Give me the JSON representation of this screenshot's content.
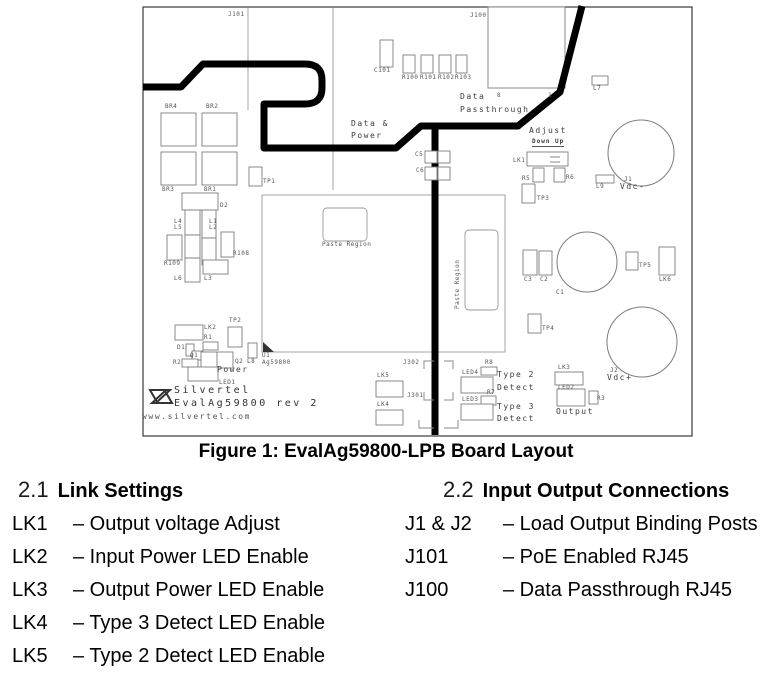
{
  "colors": {
    "background": "#ffffff",
    "text": "#000000",
    "silkscreen": "#555555",
    "trace": "#000000"
  },
  "figure_caption": "Figure 1: EvalAg59800-LPB Board Layout",
  "sections": {
    "link_settings": {
      "number": "2.1",
      "title": "Link Settings",
      "items": [
        {
          "term": "LK1",
          "desc": "– Output voltage Adjust"
        },
        {
          "term": "LK2",
          "desc": "– Input Power LED Enable"
        },
        {
          "term": "LK3",
          "desc": "– Output Power LED Enable"
        },
        {
          "term": "LK4",
          "desc": "– Type 3 Detect LED Enable"
        },
        {
          "term": "LK5",
          "desc": "– Type 2 Detect LED Enable"
        }
      ]
    },
    "io_connections": {
      "number": "2.2",
      "title": "Input Output Connections",
      "items": [
        {
          "term": "J1 & J2",
          "desc": "– Load Output Binding Posts"
        },
        {
          "term": "J101",
          "desc": "– PoE Enabled RJ45"
        },
        {
          "term": "J100",
          "desc": "– Data Passthrough RJ45"
        }
      ]
    }
  },
  "board": {
    "silkscreen_labels": [
      {
        "t": "J101",
        "x": 228,
        "y": 12
      },
      {
        "t": "J100",
        "x": 470,
        "y": 13
      },
      {
        "t": "C101",
        "x": 374,
        "y": 68
      },
      {
        "t": "R100",
        "x": 402,
        "y": 75
      },
      {
        "t": "R101",
        "x": 420,
        "y": 75
      },
      {
        "t": "R102",
        "x": 438,
        "y": 75
      },
      {
        "t": "R103",
        "x": 455,
        "y": 75
      },
      {
        "t": "L7",
        "x": 593,
        "y": 86
      },
      {
        "t": "Data",
        "x": 460,
        "y": 93,
        "c": "m"
      },
      {
        "t": "8",
        "x": 497,
        "y": 93
      },
      {
        "t": "1",
        "x": 548,
        "y": 93
      },
      {
        "t": "Passthrough",
        "x": 460,
        "y": 106,
        "c": "m"
      },
      {
        "t": "BR4",
        "x": 165,
        "y": 104
      },
      {
        "t": "BR2",
        "x": 206,
        "y": 104
      },
      {
        "t": "BR3",
        "x": 162,
        "y": 187
      },
      {
        "t": "BR1",
        "x": 204,
        "y": 187
      },
      {
        "t": "TP1",
        "x": 263,
        "y": 179
      },
      {
        "t": "Data &",
        "x": 351,
        "y": 120,
        "c": "m"
      },
      {
        "t": "Power",
        "x": 351,
        "y": 132,
        "c": "m"
      },
      {
        "t": "C5",
        "x": 415,
        "y": 152
      },
      {
        "t": "C6",
        "x": 416,
        "y": 168
      },
      {
        "t": "D2",
        "x": 220,
        "y": 203
      },
      {
        "t": "L4",
        "x": 174,
        "y": 219
      },
      {
        "t": "L5",
        "x": 174,
        "y": 225
      },
      {
        "t": "L1",
        "x": 209,
        "y": 219
      },
      {
        "t": "L2",
        "x": 209,
        "y": 225
      },
      {
        "t": "R109",
        "x": 164,
        "y": 261
      },
      {
        "t": "R108",
        "x": 233,
        "y": 251
      },
      {
        "t": "L6",
        "x": 174,
        "y": 276
      },
      {
        "t": "L3",
        "x": 204,
        "y": 276
      },
      {
        "t": "Paste Region",
        "x": 322,
        "y": 242
      },
      {
        "t": "Paste Region",
        "x": 455,
        "y": 309,
        "c": "v"
      },
      {
        "t": "Adjust",
        "x": 529,
        "y": 127,
        "c": "m"
      },
      {
        "t": "Down Up",
        "x": 532,
        "y": 139,
        "c": "u"
      },
      {
        "t": "LK1",
        "x": 513,
        "y": 158
      },
      {
        "t": "R5",
        "x": 522,
        "y": 176
      },
      {
        "t": "R6",
        "x": 566,
        "y": 175
      },
      {
        "t": "TP3",
        "x": 537,
        "y": 196
      },
      {
        "t": "L9",
        "x": 596,
        "y": 184
      },
      {
        "t": "J1",
        "x": 624,
        "y": 177
      },
      {
        "t": "Vdc-",
        "x": 620,
        "y": 183,
        "c": "m"
      },
      {
        "t": "C3",
        "x": 524,
        "y": 277
      },
      {
        "t": "C2",
        "x": 540,
        "y": 277
      },
      {
        "t": "C1",
        "x": 556,
        "y": 290
      },
      {
        "t": "TP5",
        "x": 639,
        "y": 263
      },
      {
        "t": "LK6",
        "x": 659,
        "y": 277
      },
      {
        "t": "TP4",
        "x": 542,
        "y": 326
      },
      {
        "t": "J2",
        "x": 610,
        "y": 368
      },
      {
        "t": "Vdc+",
        "x": 607,
        "y": 374,
        "c": "m"
      },
      {
        "t": "LK2",
        "x": 204,
        "y": 325
      },
      {
        "t": "TP2",
        "x": 229,
        "y": 318
      },
      {
        "t": "R1",
        "x": 204,
        "y": 335
      },
      {
        "t": "D1",
        "x": 177,
        "y": 345
      },
      {
        "t": "Q1",
        "x": 190,
        "y": 353
      },
      {
        "t": "R2",
        "x": 173,
        "y": 360
      },
      {
        "t": "Q2",
        "x": 235,
        "y": 359
      },
      {
        "t": "Power",
        "x": 217,
        "y": 366,
        "c": "m"
      },
      {
        "t": "LED1",
        "x": 219,
        "y": 380
      },
      {
        "t": "L8",
        "x": 247,
        "y": 359
      },
      {
        "t": "U1",
        "x": 262,
        "y": 353
      },
      {
        "t": "Ag59800",
        "x": 262,
        "y": 360
      },
      {
        "t": "Silvertel",
        "x": 174,
        "y": 386,
        "c": "l"
      },
      {
        "t": "EvalAg59800 rev 2",
        "x": 174,
        "y": 399,
        "c": "l"
      },
      {
        "t": "www.silvertel.com",
        "x": 142,
        "y": 413,
        "c": "w"
      },
      {
        "t": "J302",
        "x": 403,
        "y": 360
      },
      {
        "t": "LK5",
        "x": 377,
        "y": 373
      },
      {
        "t": "J301",
        "x": 407,
        "y": 393
      },
      {
        "t": "LK4",
        "x": 377,
        "y": 402
      },
      {
        "t": "R8",
        "x": 485,
        "y": 360
      },
      {
        "t": "LED4",
        "x": 462,
        "y": 370
      },
      {
        "t": "R7",
        "x": 487,
        "y": 390
      },
      {
        "t": "LED3",
        "x": 462,
        "y": 397
      },
      {
        "t": "Type 2",
        "x": 497,
        "y": 371,
        "c": "m"
      },
      {
        "t": "Detect",
        "x": 497,
        "y": 384,
        "c": "m"
      },
      {
        "t": "Type 3",
        "x": 497,
        "y": 403,
        "c": "m"
      },
      {
        "t": "Detect",
        "x": 497,
        "y": 415,
        "c": "m"
      },
      {
        "t": "LK3",
        "x": 558,
        "y": 365
      },
      {
        "t": "LED2",
        "x": 558,
        "y": 385
      },
      {
        "t": "R3",
        "x": 597,
        "y": 396
      },
      {
        "t": "Output",
        "x": 556,
        "y": 408,
        "c": "m"
      }
    ]
  }
}
